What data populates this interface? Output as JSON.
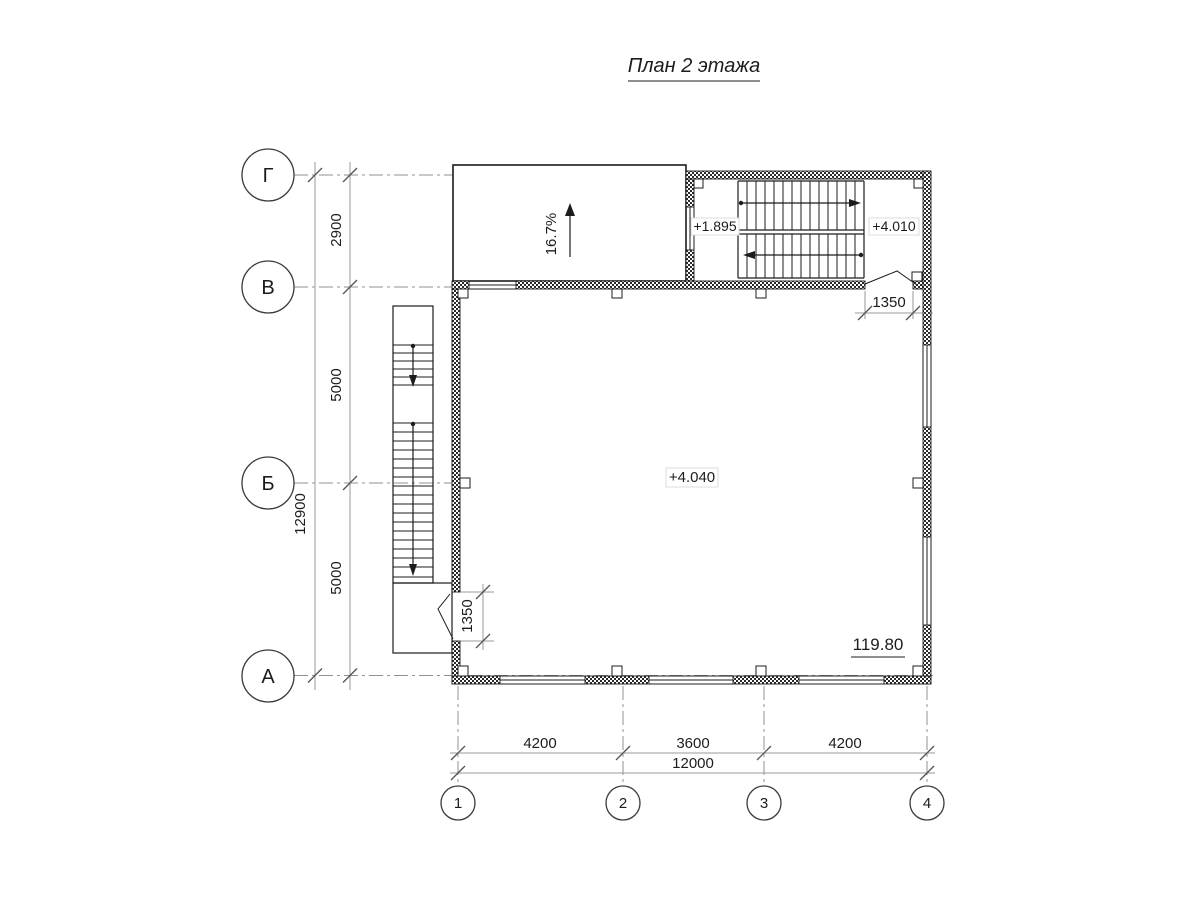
{
  "title": "План 2 этажа",
  "axes": {
    "rows": [
      {
        "label": "Г"
      },
      {
        "label": "В"
      },
      {
        "label": "Б"
      },
      {
        "label": "А"
      }
    ],
    "cols": [
      {
        "label": "1"
      },
      {
        "label": "2"
      },
      {
        "label": "3"
      },
      {
        "label": "4"
      }
    ]
  },
  "dimensions": {
    "left_total": "12900",
    "left_segments": [
      "2900",
      "5000",
      "5000"
    ],
    "bottom_segments": [
      "4200",
      "3600",
      "4200"
    ],
    "bottom_total": "12000",
    "door_left_width": "1350",
    "door_top_width": "1350"
  },
  "levels": {
    "stair_mid_landing": "+1.895",
    "stair_top_landing": "+4.010",
    "floor": "+4.040"
  },
  "ramp": {
    "slope": "16.7%"
  },
  "room": {
    "area": "119.80"
  },
  "colors": {
    "line": "#1c1c1c",
    "axis_line": "#909090",
    "dim_line": "#9a9a9a",
    "tick": "#555555",
    "label_border": "#dddddd"
  }
}
